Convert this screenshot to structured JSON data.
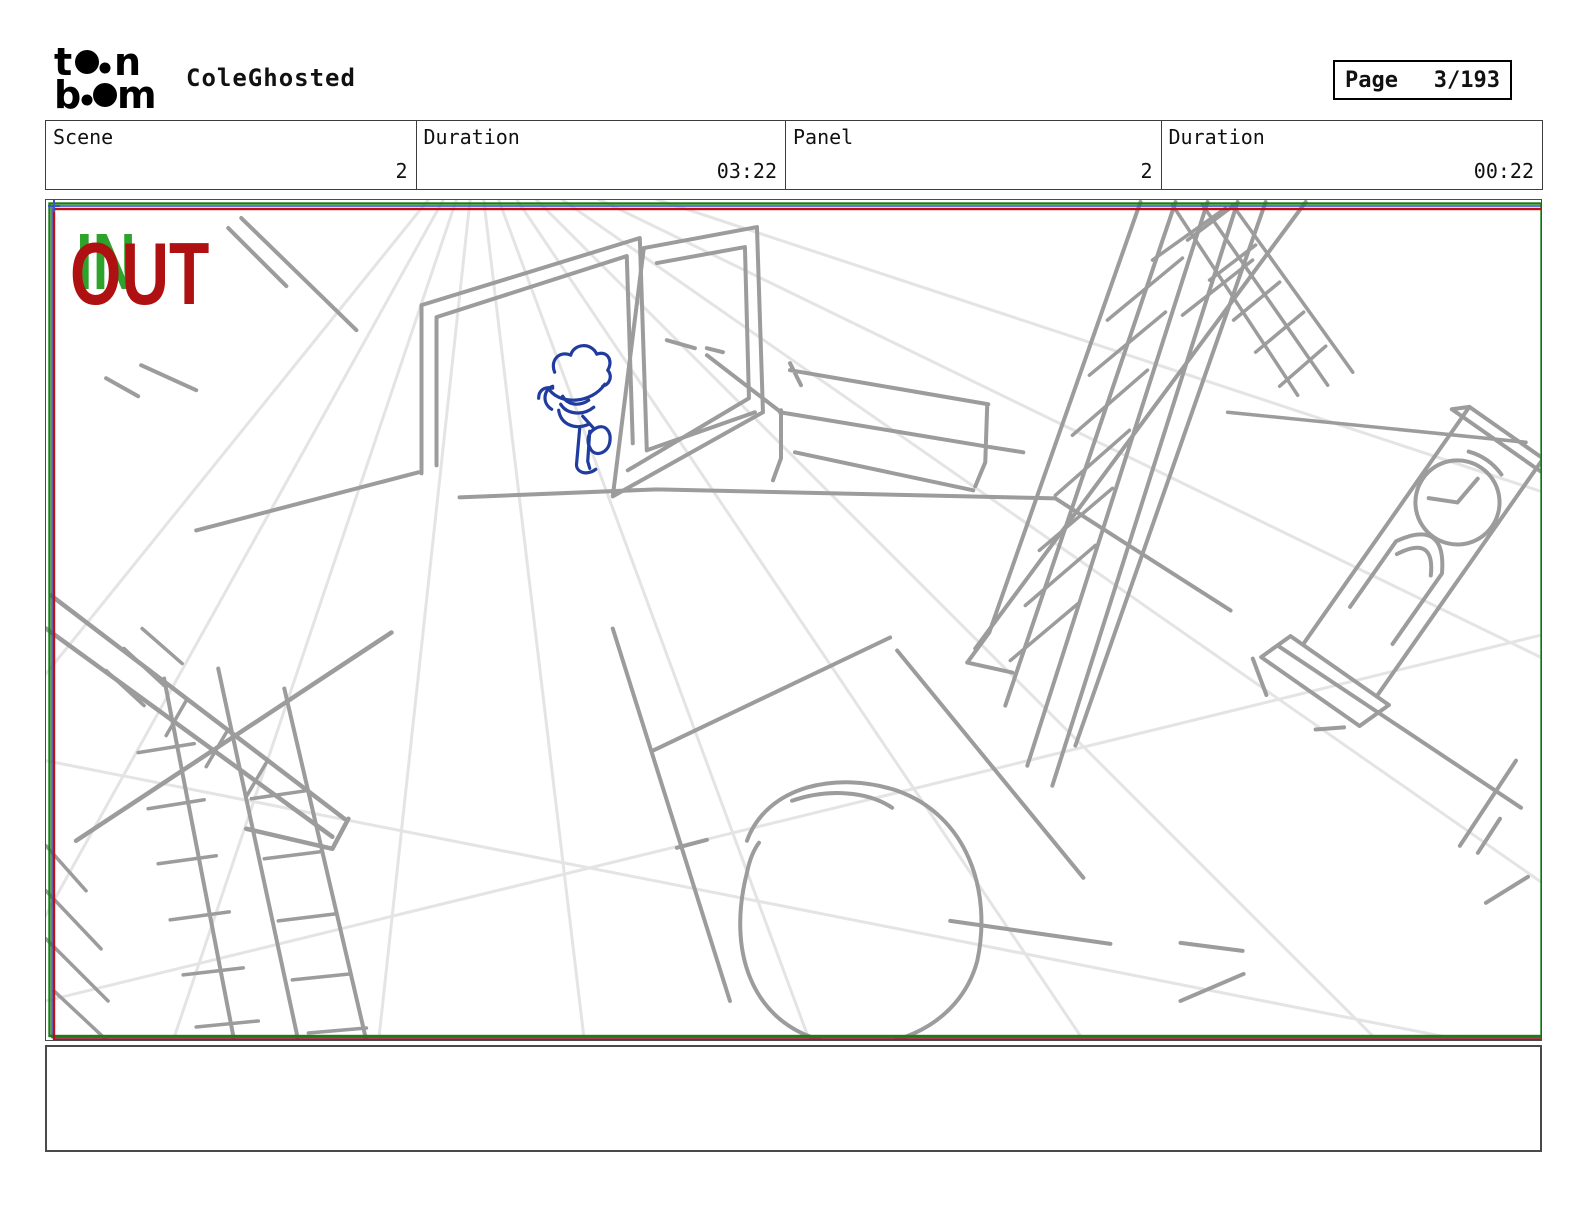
{
  "header": {
    "brand_name": "toon boom",
    "logo": {
      "line1_left": "t",
      "line1_right": "n",
      "line2_left": "b",
      "line2_right": "m"
    },
    "title": "ColeGhosted",
    "page_label": "Page",
    "page_value": "3/193"
  },
  "info_row": {
    "cells": [
      {
        "label": "Scene",
        "value": "2"
      },
      {
        "label": "Duration",
        "value": "03:22"
      },
      {
        "label": "Panel",
        "value": "2"
      },
      {
        "label": "Duration",
        "value": "00:22"
      }
    ]
  },
  "panel": {
    "in_label": "IN",
    "out_label": "OUT",
    "colors": {
      "in_text_green": "#2EA32B",
      "out_text_red": "#AF1011",
      "camera_frame_green": "#187F18",
      "camera_frame_red": "#C01015",
      "camera_frame_blue": "#3A57C8",
      "figure_blue": "#203C9E",
      "sketch_gray": "#9C9C9C",
      "guide_light_gray": "#E4E4E4"
    }
  },
  "caption": {
    "text": ""
  }
}
